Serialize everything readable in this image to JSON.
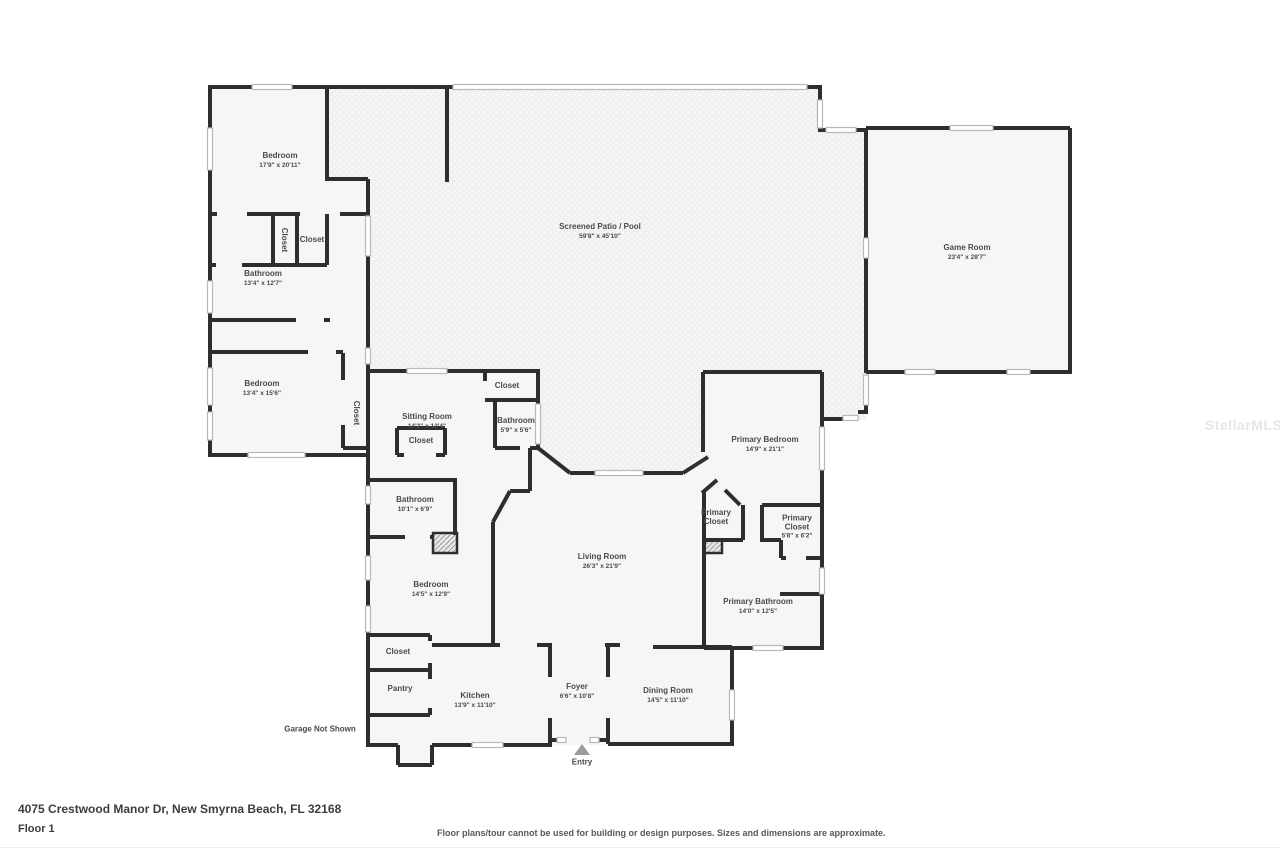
{
  "watermark": "StellarMLS",
  "footer": {
    "address": "4075 Crestwood Manor Dr, New Smyrna Beach, FL 32168",
    "floor": "Floor 1",
    "disclaimer": "Floor plans/tour cannot be used for building or design purposes. Sizes and dimensions are approximate."
  },
  "notes": {
    "garage": "Garage Not Shown",
    "entry": "Entry"
  },
  "rooms": {
    "bedroom_1": {
      "name": "Bedroom",
      "dims": "17'9\" x 20'11\""
    },
    "closet_a": {
      "name": "Closet"
    },
    "closet_b": {
      "name": "Closet"
    },
    "bathroom_1": {
      "name": "Bathroom",
      "dims": "13'4\" x 12'7\""
    },
    "bedroom_2": {
      "name": "Bedroom",
      "dims": "13'4\" x 15'6\""
    },
    "closet_c": {
      "name": "Closet"
    },
    "closet_d": {
      "name": "Closet"
    },
    "sitting_room": {
      "name": "Sitting Room",
      "dims": "14'2\" x 12'4\""
    },
    "closet_e": {
      "name": "Closet"
    },
    "bathroom_2": {
      "name": "Bathroom",
      "dims": "5'9\" x 5'6\""
    },
    "screened_patio": {
      "name": "Screened Patio / Pool",
      "dims": "59'8\" x 45'10\""
    },
    "game_room": {
      "name": "Game Room",
      "dims": "23'4\" x 28'7\""
    },
    "primary_bedroom": {
      "name": "Primary Bedroom",
      "dims": "14'9\" x 21'1\""
    },
    "bathroom_3": {
      "name": "Bathroom",
      "dims": "10'1\" x 6'9\""
    },
    "primary_closet_1": {
      "name": "Primary Closet"
    },
    "primary_closet_2": {
      "name": "Primary Closet",
      "dims": "5'8\" x 6'2\""
    },
    "living_room": {
      "name": "Living Room",
      "dims": "26'3\" x 21'9\""
    },
    "bedroom_3": {
      "name": "Bedroom",
      "dims": "14'5\" x 12'9\""
    },
    "primary_bathroom": {
      "name": "Primary Bathroom",
      "dims": "14'0\" x 12'5\""
    },
    "closet_f": {
      "name": "Closet"
    },
    "pantry": {
      "name": "Pantry"
    },
    "kitchen": {
      "name": "Kitchen",
      "dims": "13'9\" x 11'10\""
    },
    "foyer": {
      "name": "Foyer",
      "dims": "6'6\" x 10'8\""
    },
    "dining_room": {
      "name": "Dining Room",
      "dims": "14'5\" x 11'10\""
    }
  }
}
